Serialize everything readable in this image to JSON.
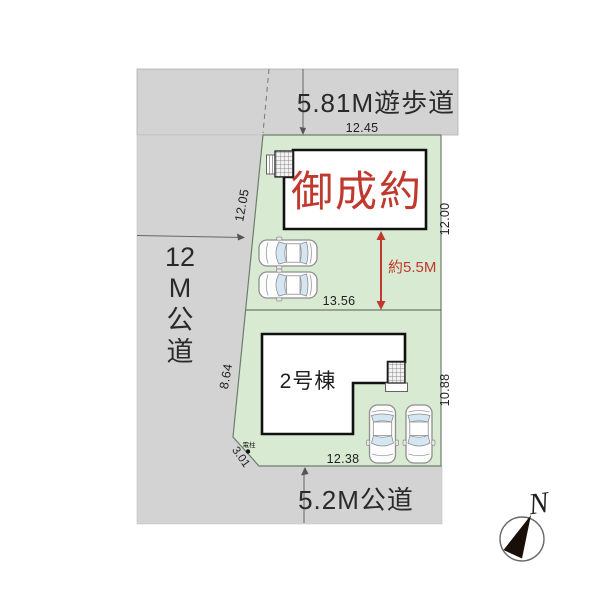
{
  "labels": {
    "walkway": "5.81M遊歩道",
    "west_road": [
      "12",
      "M",
      "公",
      "道"
    ],
    "south_road": "5.2M公道",
    "building1_status": "御成約",
    "building2_name": "2号棟",
    "gap": "約5.5M",
    "utility_pole": "電柱",
    "compass_north": "N"
  },
  "dimensions": {
    "walkway_frontage": "12.45",
    "west_upper": "12.05",
    "east_upper": "12.00",
    "middle_width": "13.56",
    "west_lower": "8.64",
    "east_lower": "10.88",
    "south_frontage": "12.38",
    "corner_cut": "3.01"
  },
  "colors": {
    "plot_green": "#d9ead3",
    "road_gray": "#d3d3d3",
    "accent_red": "#c0392e",
    "building_fill": "#ffffff",
    "car_glass": "#d4e6f2"
  }
}
